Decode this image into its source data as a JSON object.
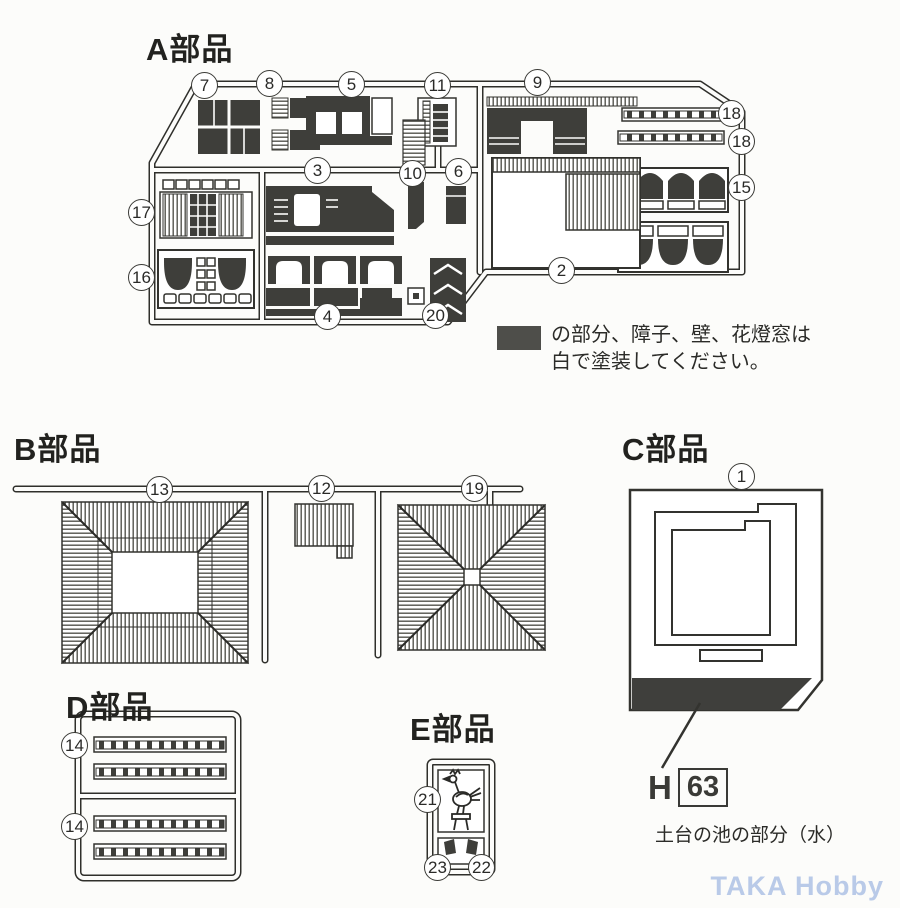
{
  "sections": {
    "a": {
      "title": "A部品"
    },
    "b": {
      "title": "B部品"
    },
    "c": {
      "title": "C部品"
    },
    "d": {
      "title": "D部品"
    },
    "e": {
      "title": "E部品"
    }
  },
  "note": {
    "line1": "の部分、障子、壁、花燈窓は",
    "line2": "白で塗装してください。"
  },
  "paint_ref": {
    "prefix": "H",
    "code": "63",
    "caption": "土台の池の部分（水）"
  },
  "watermark": {
    "text": "TAKA Hobby"
  },
  "colors": {
    "ink": "#2f2f2b",
    "dark_fill": "#3e3e3a",
    "note_swatch": "#4e4e4a",
    "watermark": "#b9cae8",
    "paper": "#fcfcfa"
  },
  "callouts": {
    "a": [
      "7",
      "8",
      "5",
      "11",
      "9",
      "18",
      "18",
      "17",
      "3",
      "10",
      "6",
      "15",
      "16",
      "2",
      "4",
      "20"
    ],
    "b": [
      "13",
      "12",
      "19"
    ],
    "c": [
      "1"
    ],
    "d": [
      "14",
      "14"
    ],
    "e": [
      "21",
      "23",
      "22"
    ]
  }
}
